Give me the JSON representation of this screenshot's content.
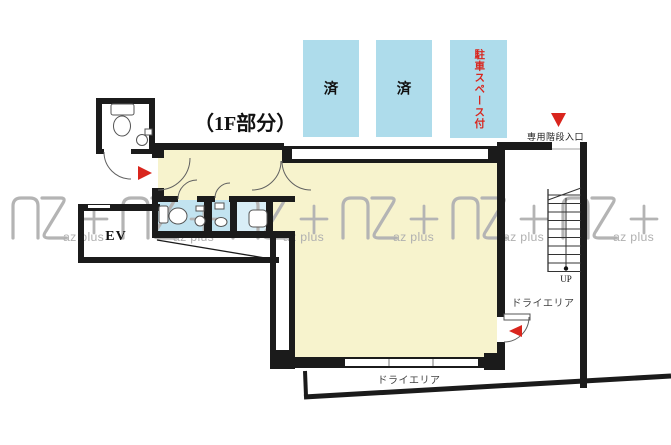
{
  "title": "（1F部分）",
  "watermark": {
    "logo_text": "AZ+",
    "label": "az plus"
  },
  "parking": {
    "spaces": [
      {
        "label": "済"
      },
      {
        "label": "済"
      },
      {
        "label": "駐車スペース付"
      }
    ]
  },
  "labels": {
    "stair_entrance": "専用階段入口",
    "elevator": "EV",
    "stairs_up": "UP",
    "dry_area_side": "ドライエリア",
    "dry_area_bottom": "ドライエリア"
  },
  "colors": {
    "wall": "#1b1b1b",
    "room": "#f7f3cd",
    "parking": "#aedceb",
    "bath": "#c2e3f0",
    "kitchen": "#d9eef7",
    "red": "#d9251d",
    "wm": "#b4b4b4"
  }
}
